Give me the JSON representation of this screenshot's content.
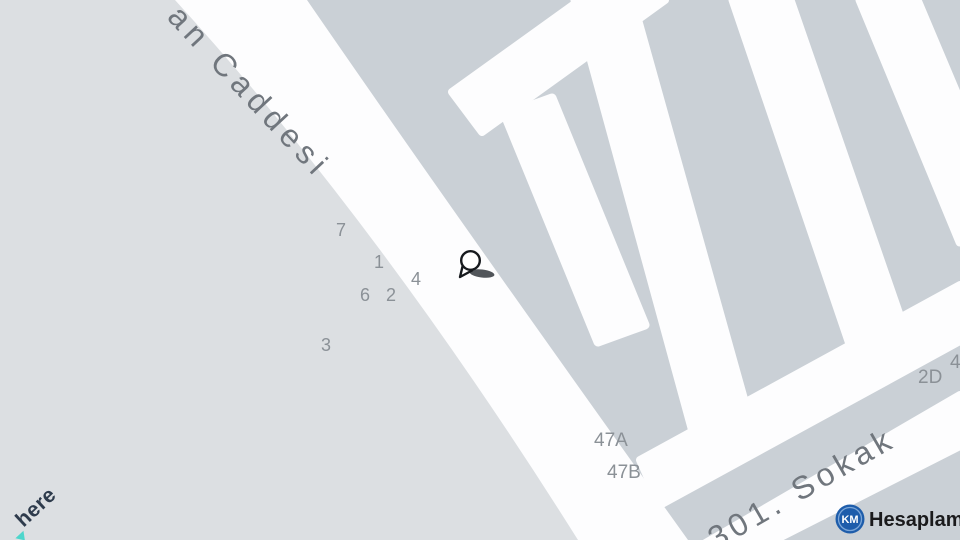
{
  "map": {
    "street_labels": [
      {
        "id": "caddesi",
        "text": "an Caddesi"
      },
      {
        "id": "sokak",
        "text": "301. Sokak"
      }
    ],
    "house_numbers": [
      {
        "text": "7"
      },
      {
        "text": "1"
      },
      {
        "text": "4"
      },
      {
        "text": "6"
      },
      {
        "text": "2"
      },
      {
        "text": "3"
      },
      {
        "text": "47A"
      },
      {
        "text": "47B"
      },
      {
        "text": "2D"
      },
      {
        "text": "4"
      }
    ],
    "marker": {
      "type": "location-pin"
    }
  },
  "branding": {
    "here": {
      "text": "here"
    },
    "km": {
      "badge": "KM",
      "text": "Hesaplama"
    }
  },
  "colors": {
    "background": "#dcdfe2",
    "block": "#cad0d6",
    "road": "#fdfdfe",
    "street_label": "#70767d",
    "house_number": "#8b9197",
    "here_navy": "#2e3b4c",
    "here_teal": "#4ed6cc",
    "km_blue": "#1e5dab"
  }
}
